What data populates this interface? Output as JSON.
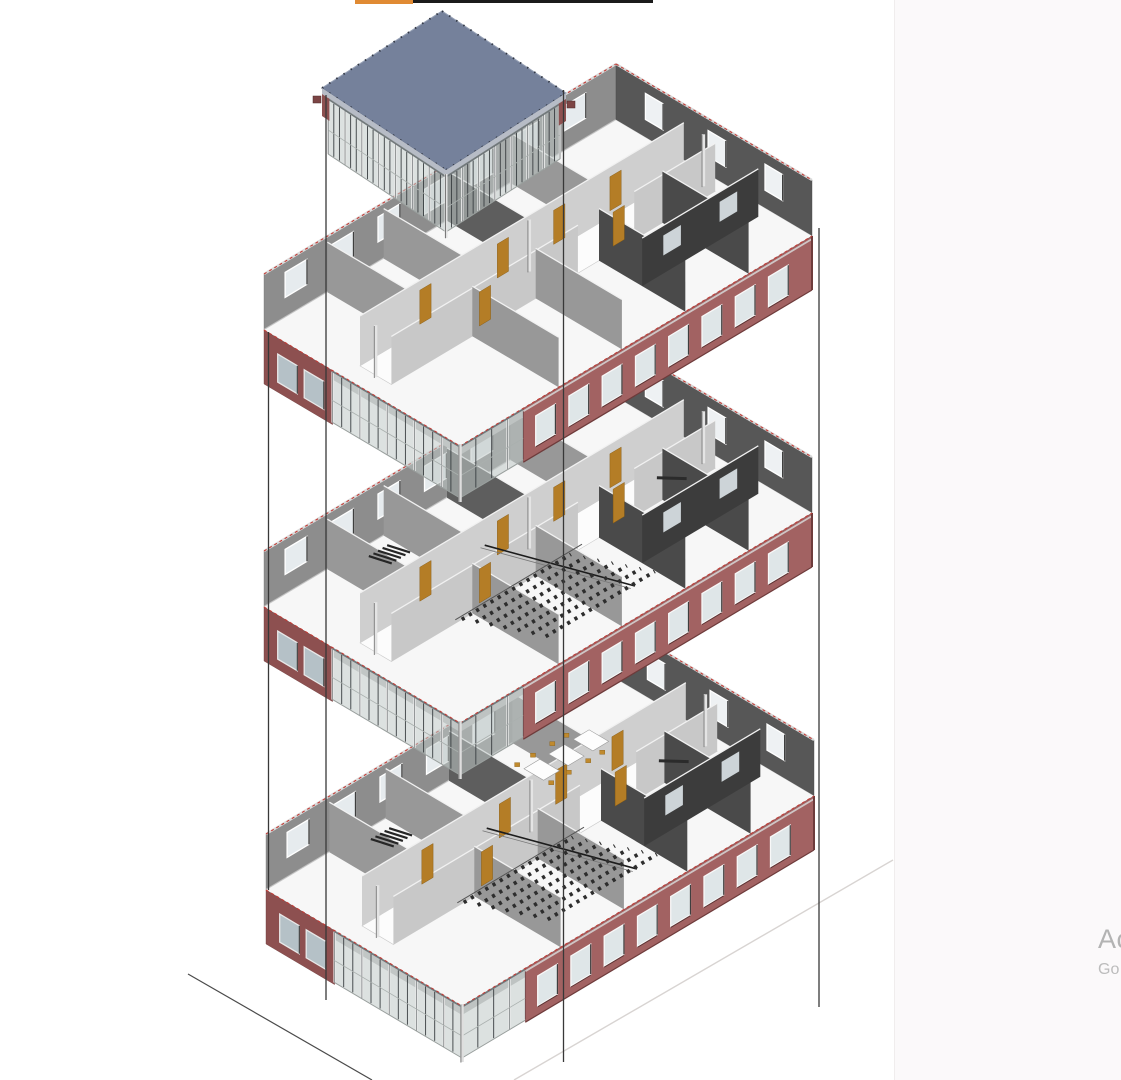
{
  "app": {
    "description": "BIM exploded axonometric view of a three-storey building with roof pavilion",
    "background": "#ffffff",
    "right_panel": {
      "x": 894,
      "color": "#fbf9fa",
      "edge_color": "#f0eded"
    }
  },
  "top_bars": {
    "orange": {
      "x": 355,
      "width": 58,
      "height": 4,
      "color": "#e08a33"
    },
    "black": {
      "x": 413,
      "width": 240,
      "height": 3,
      "color": "#1b1b1b"
    }
  },
  "watermark": {
    "line1": "Ac",
    "line2": "Go",
    "color1": "#b3b3b3",
    "color2": "#bcbcbc"
  },
  "scene": {
    "geom": {
      "U": [
        352,
        -210
      ],
      "W": [
        196,
        116
      ],
      "wall_up": 56,
      "wall_down": 54,
      "glass_depth": 52,
      "slab": 9,
      "roofU": [
        120,
        -77
      ],
      "roofW": [
        124,
        82
      ],
      "roof_glass_depth": 62
    },
    "counts": {
      "facade_windows": 8,
      "back_left_windows": 7,
      "back_right_windows": 3,
      "maroon_windows": 2,
      "seat_rows": 7
    },
    "floors": [
      {
        "x": 266,
        "y": 890,
        "seats": true,
        "stair": true,
        "diag": true,
        "furniture": true
      },
      {
        "x": 264,
        "y": 607,
        "seats": true,
        "stair": true,
        "diag": true,
        "furniture": false
      },
      {
        "x": 264,
        "y": 330,
        "seats": false,
        "stair": false,
        "diag": false,
        "furniture": false
      }
    ],
    "roof": {
      "x": 322,
      "y": 88
    },
    "vlines": [
      {
        "x": 268.5,
        "y1": 332,
        "y2": 890
      },
      {
        "x": 326,
        "y1": 95,
        "y2": 1000
      },
      {
        "x": 563.5,
        "y1": 90,
        "y2": 1062
      },
      {
        "x": 819,
        "y1": 228,
        "y2": 1007
      }
    ],
    "ground_lines": [
      {
        "x1": 188,
        "y1": 974,
        "x2": 372,
        "y2": 1080,
        "light": false
      },
      {
        "x1": 514,
        "y1": 1080,
        "x2": 893,
        "y2": 860,
        "light": true
      }
    ],
    "colors": {
      "slabTop": "#f7f7f7",
      "slabStroke": "#d2d2d2",
      "slabEdge": "#c4c4c4",
      "backWallL": "#8d8d8d",
      "backWallR": "#575757",
      "wallStroke": "#767676",
      "winHole": "#e6ebee",
      "winFrame": "#ffffff",
      "winJamb": "#3f3f3f",
      "facade": "#a26262",
      "facadeDark": "#6e3c3c",
      "facadeWin": "#dfe6e8",
      "facadeWinFrame": "#f8f8f8",
      "maroon": "#8d5050",
      "maroonWin": "#b5c1c7",
      "glass": "rgba(191,200,198,0.55)",
      "glassEdge": "#8f9693",
      "mullion": "#383d40",
      "post": "#e8e8e8",
      "glassTop": "#70777a",
      "glassBottom": "#9aa09e",
      "corridor": "#fcfcfc",
      "corridorEdge": "#c9c9c9",
      "partLight": "#cfcfcf",
      "partMid": "#989898",
      "partDark": "#4a4a4a",
      "partDarker": "#3c3c3c",
      "partTop": "#f1f1f1",
      "door": "#b47d26",
      "doorEdge": "#81570f",
      "seat": "#2d2d2d",
      "stair": "#262626",
      "diagLine": "#1c1c1c",
      "column": "#e4e4e4",
      "columnEdge": "#6d6d6d",
      "dash": "#c23b35",
      "roofTop": "#75819b",
      "roofStroke": "#5e6b84",
      "roofBand": "#b7bcc6",
      "roofTick": "#2f3542",
      "roofHighlight": "#9aa4b8",
      "vline": "#383838",
      "groundDark": "#4a4a4a",
      "groundLight": "#d8d4d2"
    }
  }
}
